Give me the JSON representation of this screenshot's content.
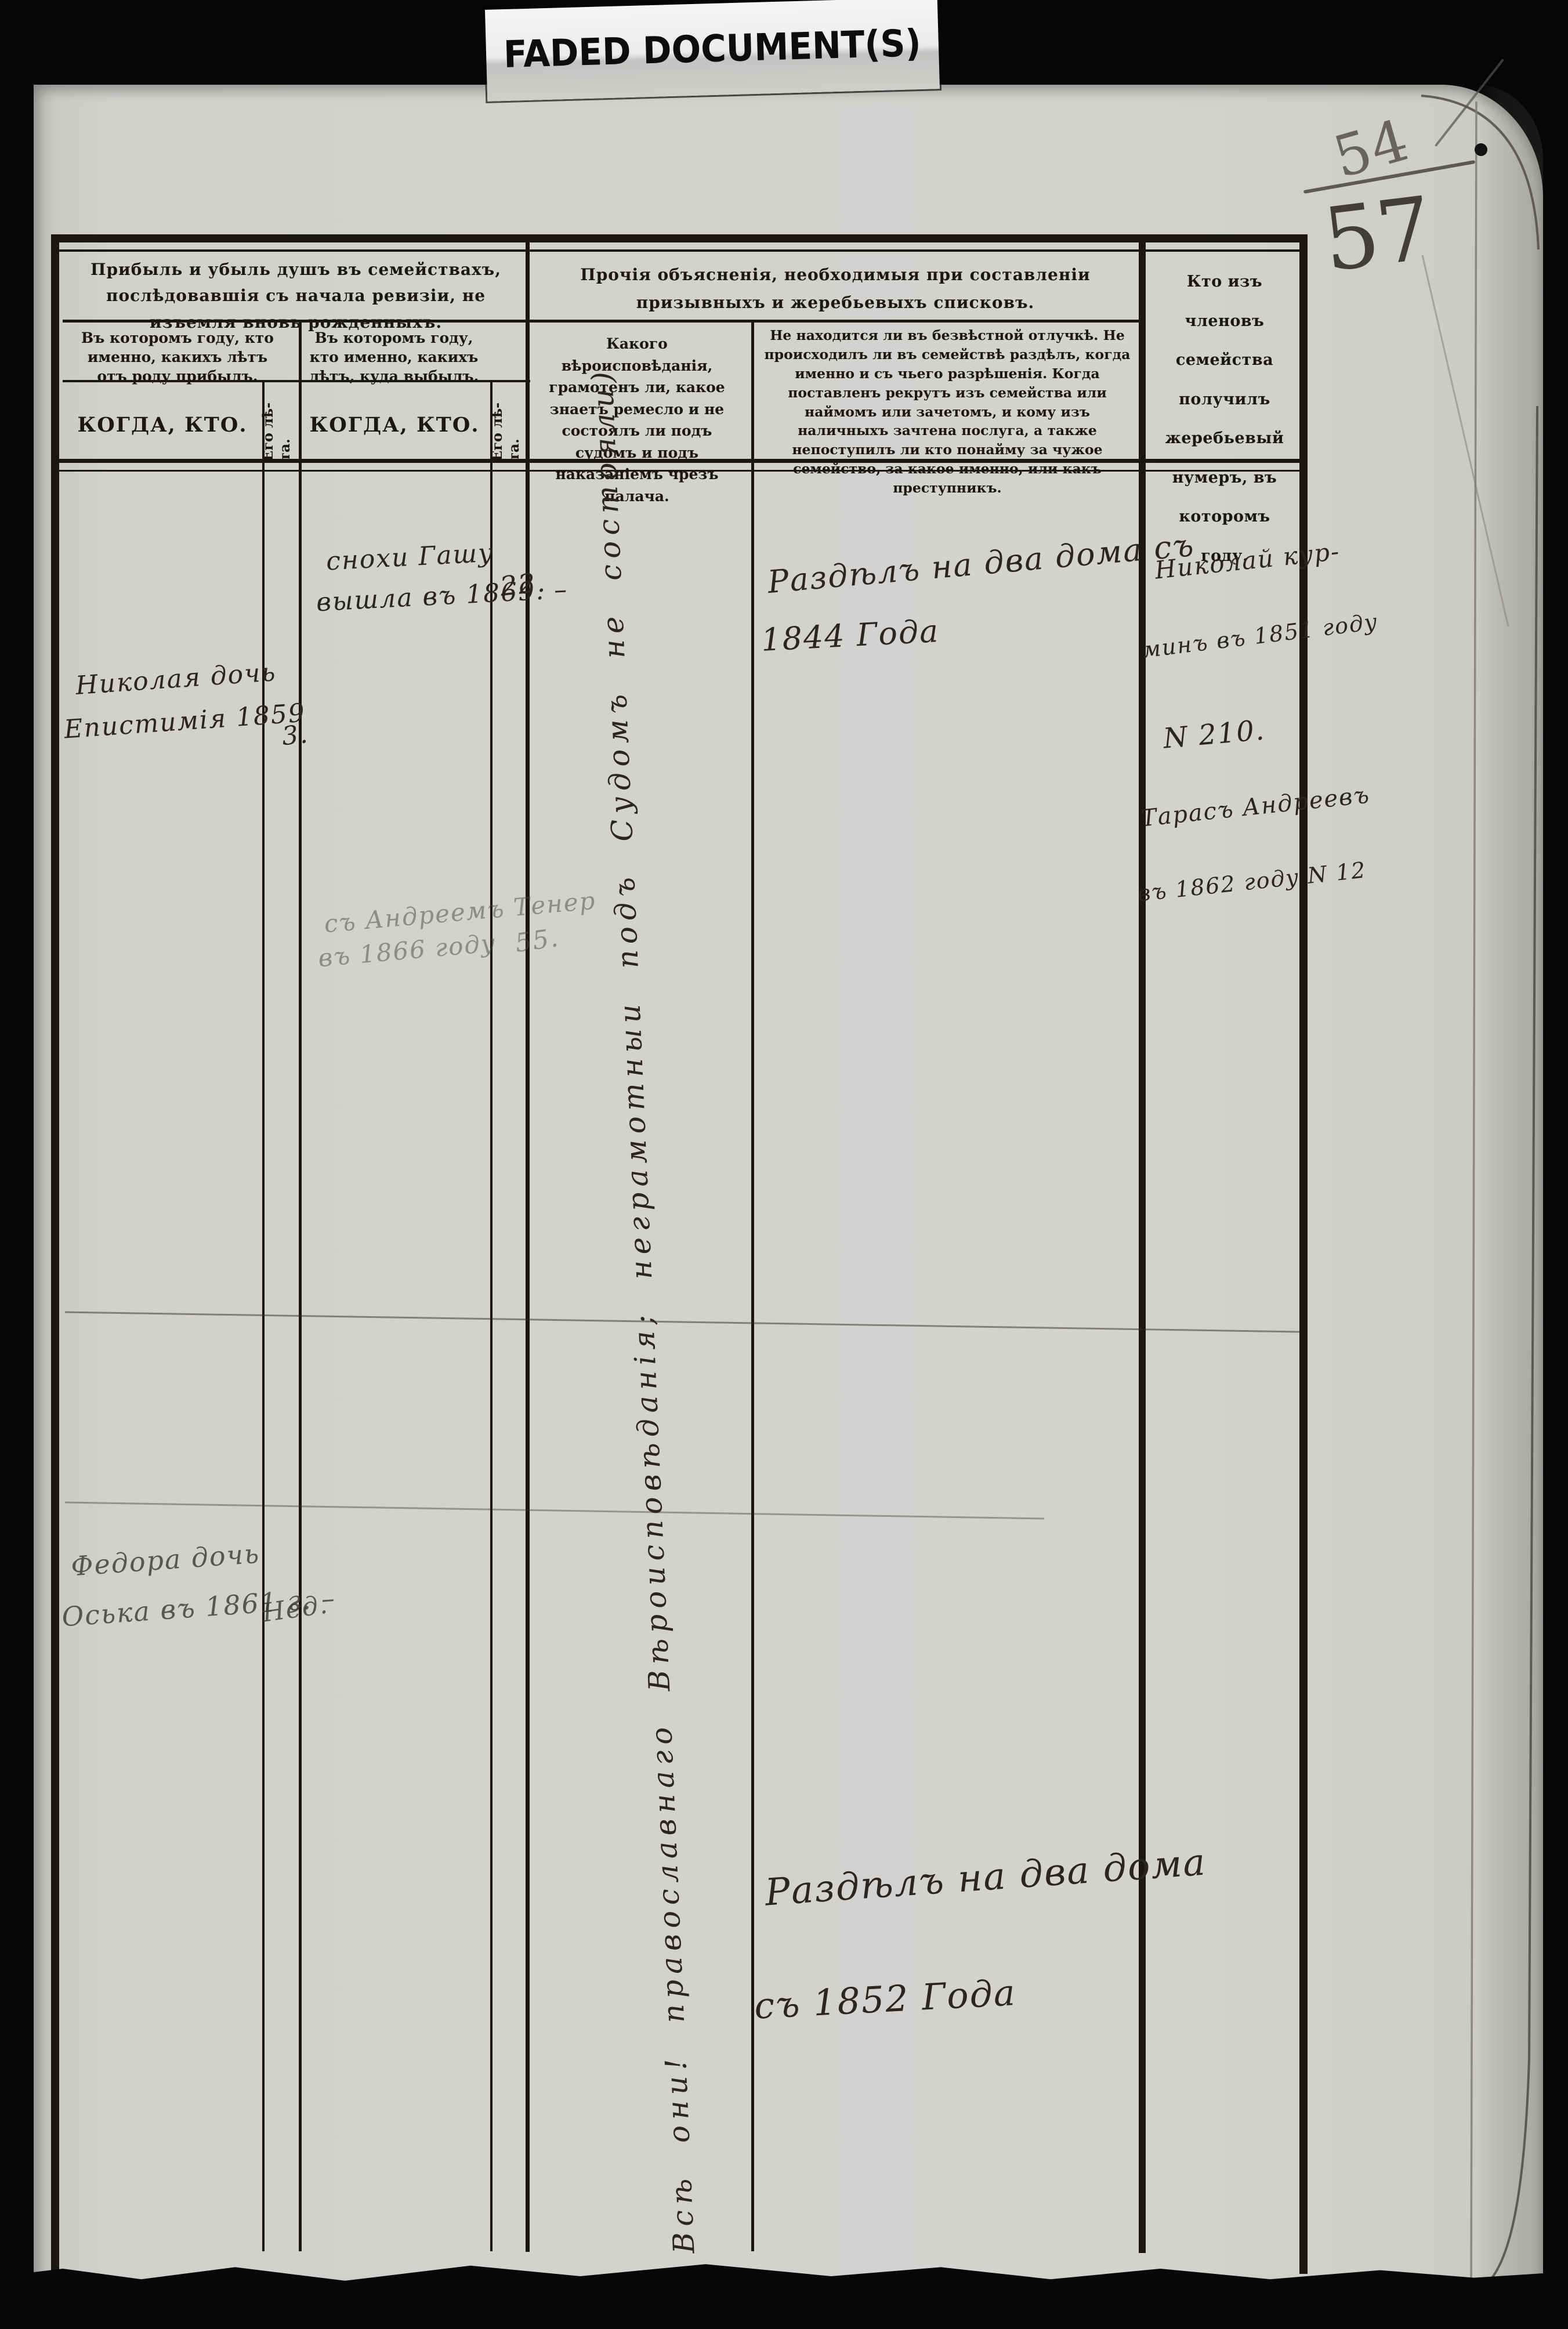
{
  "banner": {
    "label": "FADED DOCUMENT(S)"
  },
  "page": {
    "number": "57",
    "number_crossed": "54"
  },
  "header": {
    "group_arrivals": "Прибыль и убыль душъ въ семействахъ, послѣдовавшія съ начала ревизіи, не изъемля вновь рожденныхъ.",
    "group_explanations": "Прочія объясненія, необходимыя при составленіи призывныхъ и жеребьевыхъ списковъ.",
    "group_lot": "Кто изъ членовъ семейства получилъ жеребьевый нумеръ, въ которомъ году.",
    "sub_arrived": "Въ которомъ году, кто именно, какихъ лѣтъ отъ роду прибылъ.",
    "sub_departed": "Въ которомъ году, кто именно, какихъ лѣтъ, куда выбылъ.",
    "when_who": "КОГДА, КТО.",
    "age_label_line1": "Его лѣ-",
    "age_label_line2": "та.",
    "sub_faith": "Какого вѣроисповѣданія, грамотенъ ли, какое знаетъ ремесло и не состоялъ ли подъ судомъ и подъ наказаніемъ чрезъ палача.",
    "sub_absence": "Не находится ли въ безвѣстной отлучкѣ. Не происходилъ ли въ семействѣ раздѣлъ, когда именно и съ чьего разрѣшенія. Когда поставленъ рекрутъ изъ семейства или наймомъ или зачетомъ, и кому изъ наличныхъ зачтена послуга, а также непоступилъ ли кто понайму за чужое семейство, за какое именно, или какъ преступникъ."
  },
  "entries": {
    "departed_1": {
      "line1": "снохи Гашу",
      "line2": "вышла въ 1869. –",
      "age": "22."
    },
    "arrived_1": {
      "line1": "Николая дочь",
      "line2": "Епистимія 1859",
      "age": "3."
    },
    "departed_2": {
      "line1": "съ Андреемъ Тенер",
      "line2": "въ 1866 году",
      "age": "55."
    },
    "arrived_2": {
      "line1": "Федора дочь",
      "line2": "Оська въ 1861 г. –",
      "age": "Нед."
    }
  },
  "notes": {
    "division_1844": {
      "line1": "Раздѣлъ на два дома съ",
      "line2": "1844 Года"
    },
    "lot_numbers": {
      "line1": "Николай кур-",
      "line2": "минъ въ 1851 году",
      "line3": "N 210.",
      "line4": "Тарасъ Андреевъ",
      "line5": "въ 1862 году N 12"
    },
    "division_1852": {
      "line1": "Раздѣлъ на два дома",
      "line2": "съ 1852 Года"
    },
    "faith_note": "Всѣ они! православнаго Вѣроисповѣданія; неграмотныи подъ Судомъ не состояли)"
  }
}
